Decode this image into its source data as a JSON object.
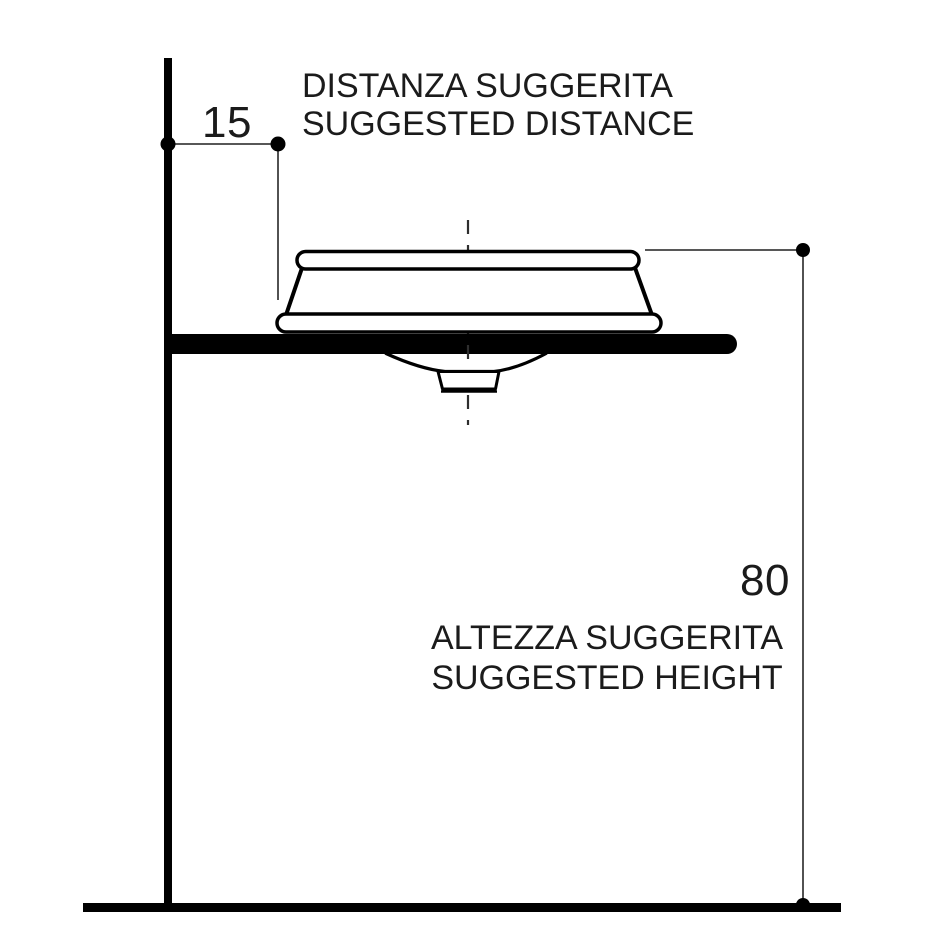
{
  "diagram": {
    "subject": "washbasin-installation-side-view",
    "top_annotation": {
      "line1": "DISTANZA SUGGERITA",
      "line2": "SUGGESTED DISTANCE",
      "dimension_value": "15"
    },
    "bottom_annotation": {
      "line1": "ALTEZZA SUGGERITA",
      "line2": "SUGGESTED HEIGHT",
      "dimension_value": "80"
    },
    "colors": {
      "drawing_line": "#000000",
      "dimension_line": "#3f3f3f",
      "text": "#1b1b1b",
      "background": "#ffffff"
    }
  }
}
